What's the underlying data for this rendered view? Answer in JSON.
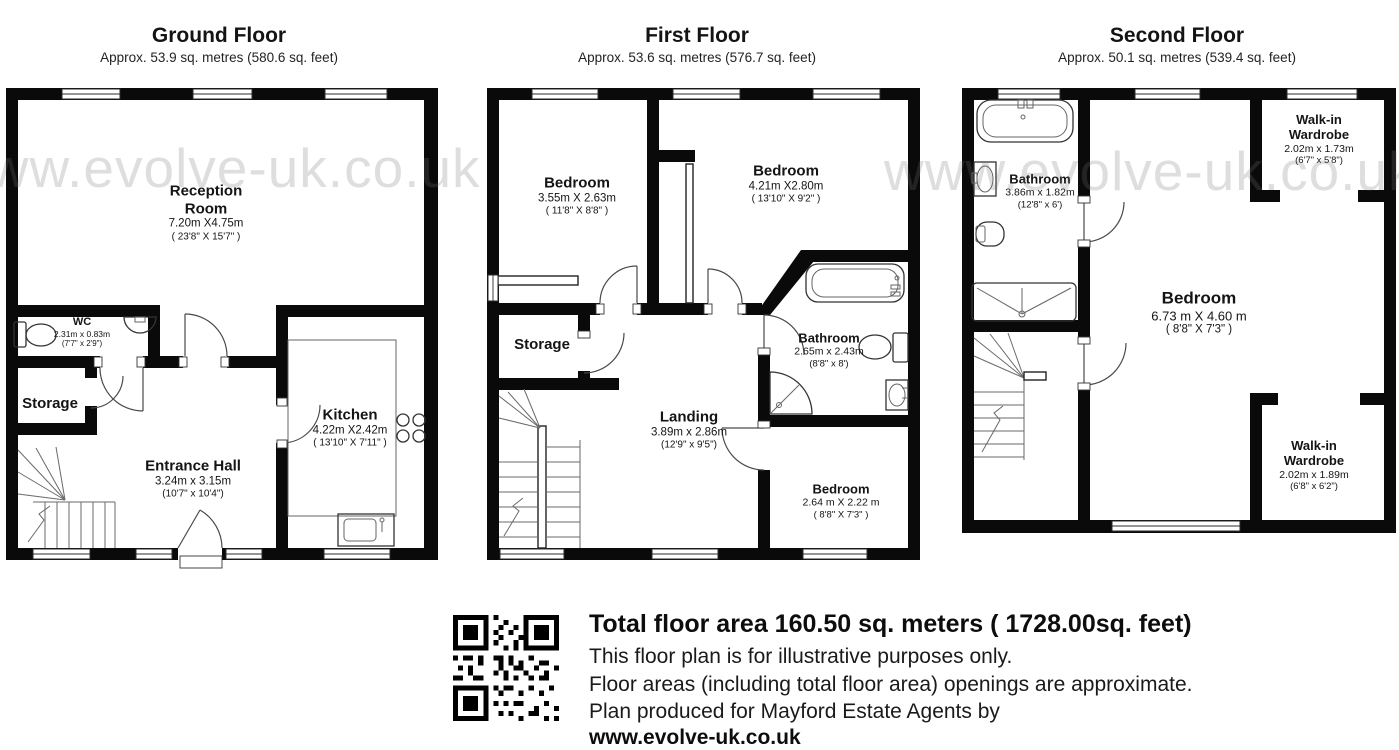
{
  "watermark": {
    "text": "www.evolve-uk.co.uk"
  },
  "colors": {
    "wall": "#0a0a0a",
    "watermark_gray": "#d9d9d9",
    "background": "#ffffff"
  },
  "floors": [
    {
      "id": "ground",
      "title": "Ground Floor",
      "subtitle": "Approx. 53.9 sq. metres (580.6 sq. feet)",
      "rooms": [
        {
          "name": "Reception Room",
          "metric": "7.20m X4.75m",
          "imperial": "( 23'8\" X 15'7\" )"
        },
        {
          "name": "WC",
          "metric": "2.31m x 0.83m",
          "imperial": "(7'7\" x 2'9\")"
        },
        {
          "name": "Storage"
        },
        {
          "name": "Entrance Hall",
          "metric": "3.24m x 3.15m",
          "imperial": "(10'7\" x 10'4\")"
        },
        {
          "name": "Kitchen",
          "metric": "4.22m X2.42m",
          "imperial": "( 13'10\" X 7'11\" )"
        }
      ]
    },
    {
      "id": "first",
      "title": "First Floor",
      "subtitle": "Approx. 53.6 sq. metres (576.7 sq. feet)",
      "rooms": [
        {
          "name": "Bedroom",
          "metric": "3.55m X 2.63m",
          "imperial": "( 11'8\" X 8'8\" )"
        },
        {
          "name": "Bedroom",
          "metric": "4.21m X2.80m",
          "imperial": "( 13'10\" X 9'2\" )"
        },
        {
          "name": "Storage"
        },
        {
          "name": "Landing",
          "metric": "3.89m x 2.86m",
          "imperial": "(12'9\" x 9'5\")"
        },
        {
          "name": "Bathroom",
          "metric": "2.65m x 2.43m",
          "imperial": "(8'8\" x 8')"
        },
        {
          "name": "Bedroom",
          "metric": "2.64 m X 2.22 m",
          "imperial": "( 8'8\" X 7'3\" )"
        }
      ]
    },
    {
      "id": "second",
      "title": "Second Floor",
      "subtitle": "Approx. 50.1 sq. metres (539.4 sq. feet)",
      "rooms": [
        {
          "name": "Bathroom",
          "metric": "3.86m x 1.82m",
          "imperial": "(12'8\" x 6')"
        },
        {
          "name": "Walk-in Wardrobe",
          "metric": "2.02m x 1.73m",
          "imperial": "(6'7\" x 5'8\")"
        },
        {
          "name": "Bedroom",
          "metric": "6.73 m X 4.60 m",
          "imperial": "( 8'8\" X 7'3\" )"
        },
        {
          "name": "Walk-in Wardrobe",
          "metric": "2.02m x 1.89m",
          "imperial": "(6'8\" x 6'2\")"
        }
      ]
    }
  ],
  "footer": {
    "total_line": "Total floor area 160.50 sq. meters (  1728.00sq. feet)",
    "line1": "This floor plan is for illustrative purposes only.",
    "line2": "Floor areas (including total floor area) openings are approximate.",
    "line3": "Plan produced for Mayford Estate Agents by",
    "website": "www.evolve-uk.co.uk"
  }
}
